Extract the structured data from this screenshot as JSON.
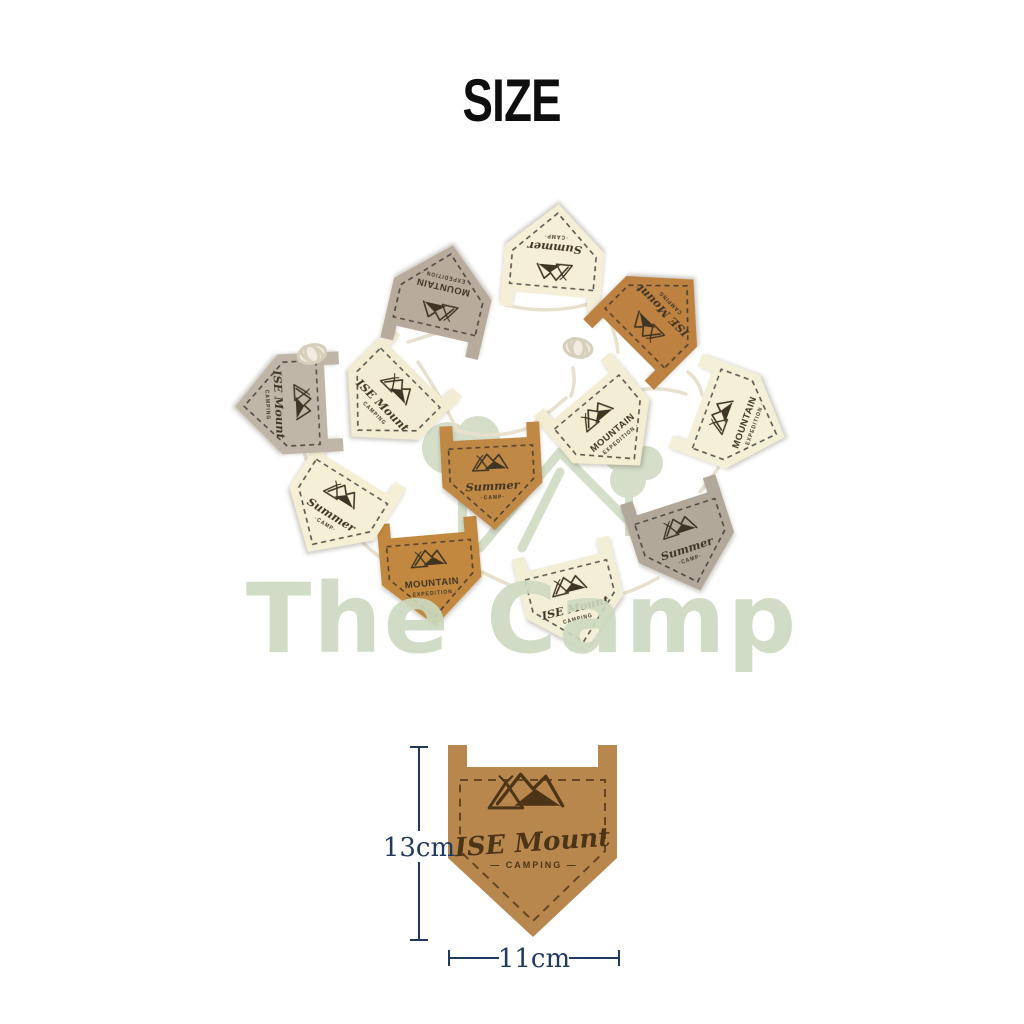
{
  "page": {
    "title": "SIZE",
    "background": "#ffffff"
  },
  "ring": {
    "cord_color": "#e7e0cc",
    "flags": [
      {
        "position": "top",
        "color": "#f4efd6",
        "style": "summer",
        "line1": "Summer",
        "line2": "·CAMP·"
      },
      {
        "position": "top-right",
        "color": "#bd8142",
        "style": "ise",
        "line1": "ISE Mount",
        "line2": "CAMPING"
      },
      {
        "position": "right-outer",
        "color": "#f4efd7",
        "style": "mountain",
        "line1": "MOUNTAIN",
        "line2": "· EXPEDITION ·"
      },
      {
        "position": "right-inner",
        "color": "#f2edd3",
        "style": "mountain",
        "line1": "MOUNTAIN",
        "line2": "· EXPEDITION ·"
      },
      {
        "position": "bottom-right",
        "color": "#b2a89a",
        "style": "summer",
        "line1": "Summer",
        "line2": "·CAMP·"
      },
      {
        "position": "bottom",
        "color": "#f3eed6",
        "style": "ise",
        "line1": "ISE Mount",
        "line2": "CAMPING"
      },
      {
        "position": "bottom-center",
        "color": "#c2883f",
        "style": "mountain",
        "line1": "MOUNTAIN",
        "line2": "· EXPEDITION ·"
      },
      {
        "position": "bottom-left",
        "color": "#f4efd5",
        "style": "summer",
        "line1": "Summer",
        "line2": "·CAMP·"
      },
      {
        "position": "center",
        "color": "#c08845",
        "style": "summer",
        "line1": "Summer",
        "line2": "·CAMP·"
      },
      {
        "position": "left-inner",
        "color": "#f2edd2",
        "style": "ise",
        "line1": "ISE Mount",
        "line2": "CAMPING"
      },
      {
        "position": "left-outer",
        "color": "#c0b6a8",
        "style": "ise",
        "line1": "ISE Mount",
        "line2": "CAMPING"
      },
      {
        "position": "top-left",
        "color": "#b7ab9b",
        "style": "mountain",
        "line1": "MOUNTAIN",
        "line2": "· EXPEDITION ·"
      }
    ]
  },
  "watermark": {
    "text": "The Camp",
    "color": "#cdd9c0"
  },
  "diagram": {
    "flag_color": "#b8874e",
    "stitch_color": "#5d3f1e",
    "ink_color": "#4c3517",
    "logo_line1": "ISE Mount",
    "logo_line2": "— CAMPING —",
    "height_label": "13cm",
    "width_label": "11cm",
    "dimension_color": "#1f3a5e"
  }
}
